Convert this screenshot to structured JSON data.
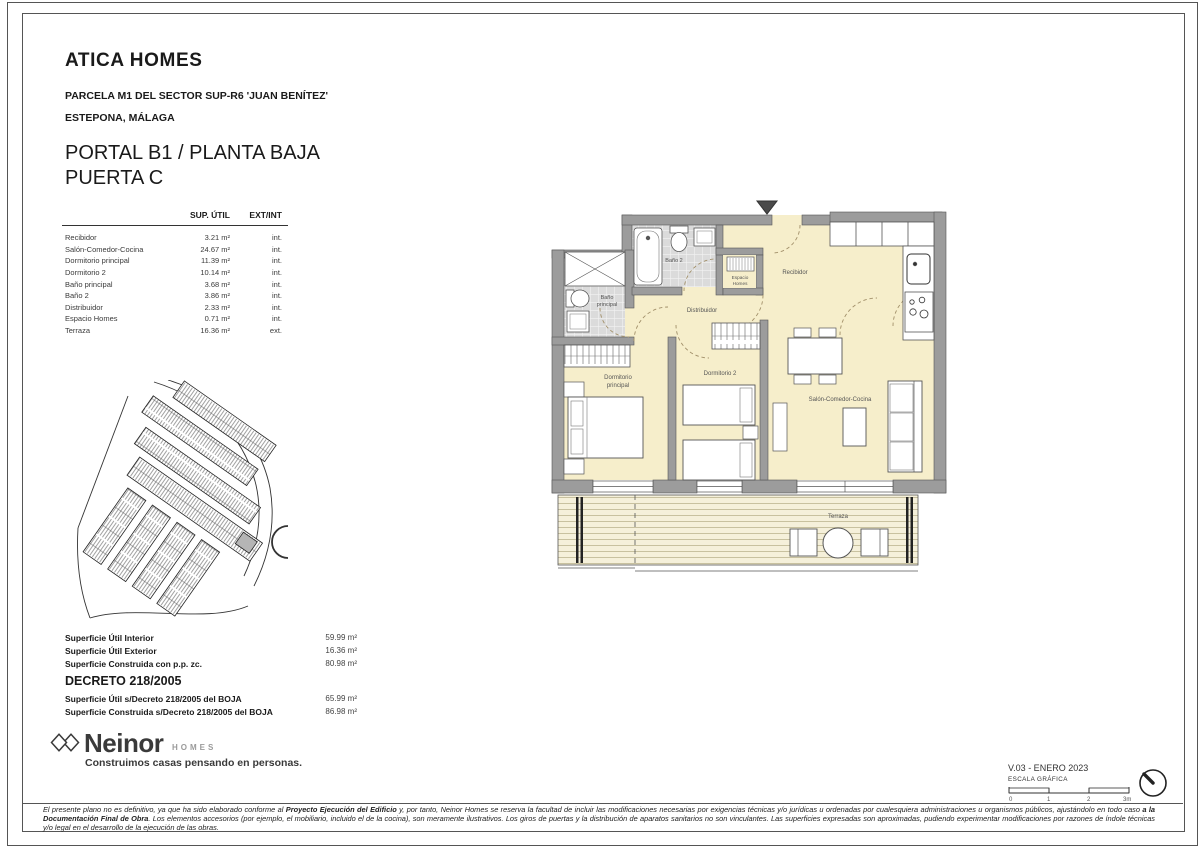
{
  "header": {
    "project": "ATICA HOMES",
    "parcel": "PARCELA M1 DEL SECTOR SUP-R6 'JUAN BENÍTEZ'",
    "city": "ESTEPONA, MÁLAGA",
    "portal_line1": "PORTAL B1 / PLANTA BAJA",
    "portal_line2": "PUERTA C"
  },
  "areas_table": {
    "col_area": "SUP. ÚTIL",
    "col_type": "EXT/INT",
    "rows": [
      {
        "name": "Recibidor",
        "area": "3.21 m²",
        "type": "int."
      },
      {
        "name": "Salón-Comedor-Cocina",
        "area": "24.67 m²",
        "type": "int."
      },
      {
        "name": "Dormitorio principal",
        "area": "11.39 m²",
        "type": "int."
      },
      {
        "name": "Dormitorio 2",
        "area": "10.14 m²",
        "type": "int."
      },
      {
        "name": "Baño principal",
        "area": "3.68 m²",
        "type": "int."
      },
      {
        "name": "Baño 2",
        "area": "3.86 m²",
        "type": "int."
      },
      {
        "name": "Distribuidor",
        "area": "2.33 m²",
        "type": "int."
      },
      {
        "name": "Espacio Homes",
        "area": "0.71 m²",
        "type": "int."
      },
      {
        "name": "Terraza",
        "area": "16.36 m²",
        "type": "ext."
      }
    ]
  },
  "summary": {
    "rows": [
      {
        "label": "Superficie Útil Interior",
        "value": "59.99 m²"
      },
      {
        "label": "Superficie Útil Exterior",
        "value": "16.36 m²"
      },
      {
        "label": "Superficie Construida con p.p. zc.",
        "value": "80.98 m²"
      }
    ]
  },
  "decreto": {
    "title": "DECRETO 218/2005",
    "rows": [
      {
        "label": "Superficie Útil s/Decreto 218/2005 del BOJA",
        "value": "65.99 m²"
      },
      {
        "label": "Superficie Construida s/Decreto 218/2005 del BOJA",
        "value": "86.98 m²"
      }
    ]
  },
  "brand": {
    "name": "Neinor",
    "suffix": "HOMES",
    "tagline": "Construimos casas pensando en personas."
  },
  "plan": {
    "labels": {
      "recibidor": "Recibidor",
      "distribuidor": "Distribuidor",
      "bano2": "Baño 2",
      "bano_ppal_1": "Baño",
      "bano_ppal_2": "principal",
      "espacio_1": "Espacio",
      "espacio_2": "Homes",
      "dorm_ppal_1": "Dormitorio",
      "dorm_ppal_2": "principal",
      "dorm2": "Dormitorio 2",
      "salon": "Salón-Comedor-Cocina",
      "terraza": "Terraza"
    },
    "colors": {
      "floor": "#f6eecb",
      "wall": "#9c9c9c",
      "tile": "#dbdbdb",
      "deck": "#f5f0da"
    }
  },
  "footer": {
    "version": "V.03 - ENERO 2023",
    "scale_label": "ESCALA GRÁFICA",
    "scale_ticks": [
      "0",
      "1",
      "2",
      "3m"
    ],
    "disclaimer": [
      {
        "text": "El presente plano no es definitivo, ya que ha sido elaborado conforme al ",
        "bold": false
      },
      {
        "text": "Proyecto Ejecución del Edificio",
        "bold": true
      },
      {
        "text": " y, por tanto, Neinor Homes se reserva la facultad de incluir las modificaciones necesarias por exigencias técnicas y/o jurídicas u ordenadas por cualesquiera administraciones u organismos públicos, ajustándolo en todo caso ",
        "bold": false
      },
      {
        "text": "a la Documentación Final de Obra",
        "bold": true
      },
      {
        "text": ". Los elementos accesorios (por ejemplo, el mobiliario, incluido el de la cocina), son meramente ilustrativos. Los giros de puertas y la distribución de aparatos sanitarios no son vinculantes. Las superficies expresadas son aproximadas, pudiendo experimentar modificaciones por razones de índole técnicas y/o legal en el desarrollo de la ejecución de las obras.",
        "bold": false
      }
    ]
  }
}
